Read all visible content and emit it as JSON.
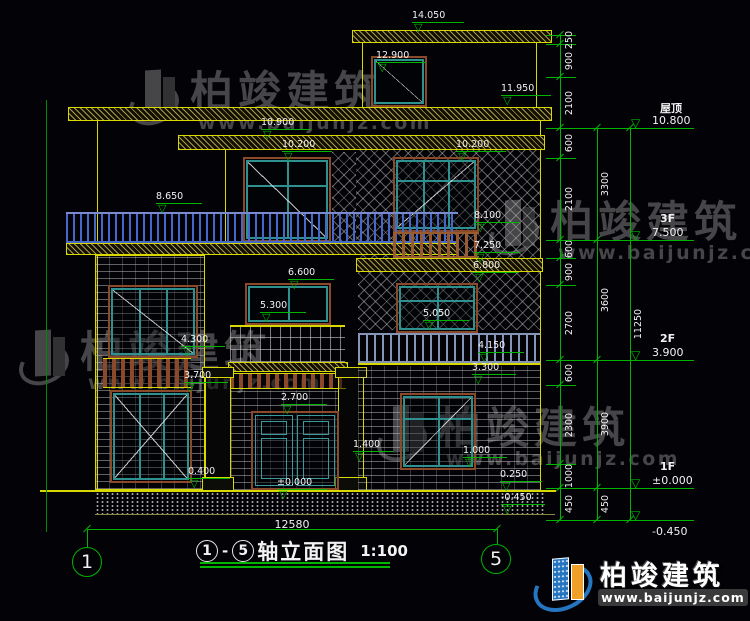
{
  "colors": {
    "line_yellow": "#d9d900",
    "dim_green": "#00b400",
    "text_white": "#f2f2f2",
    "frame_teal": "#2f9090",
    "frame_brown": "#8a4a2a",
    "railing_blue": "#4468cc",
    "logo_blue": "#2575c0",
    "logo_orange": "#f0a028",
    "watermark_gray": "#9a9a9a"
  },
  "icons": {
    "level_triangle": "▽"
  },
  "drawing": {
    "markers": [
      {
        "t": "14.050",
        "x": 412,
        "y": 11,
        "w": 52
      },
      {
        "t": "12.900",
        "x": 376,
        "y": 51,
        "w": 50
      },
      {
        "t": "11.950",
        "x": 501,
        "y": 84,
        "w": 50
      },
      {
        "t": "10.900",
        "x": 261,
        "y": 118,
        "w": 50
      },
      {
        "t": "10.200",
        "x": 282,
        "y": 140,
        "w": 50
      },
      {
        "t": "10.200",
        "x": 456,
        "y": 140,
        "w": 50
      },
      {
        "t": "8.650",
        "x": 156,
        "y": 192,
        "w": 46
      },
      {
        "t": "8.100",
        "x": 474,
        "y": 211,
        "w": 46
      },
      {
        "t": "7.250",
        "x": 474,
        "y": 241,
        "w": 46
      },
      {
        "t": "6.800",
        "x": 473,
        "y": 261,
        "w": 46
      },
      {
        "t": "6.600",
        "x": 288,
        "y": 268,
        "w": 46
      },
      {
        "t": "5.300",
        "x": 260,
        "y": 301,
        "w": 46
      },
      {
        "t": "5.050",
        "x": 423,
        "y": 309,
        "w": 46
      },
      {
        "t": "4.300",
        "x": 181,
        "y": 335,
        "w": 44
      },
      {
        "t": "3.700",
        "x": 184,
        "y": 371,
        "w": 44
      },
      {
        "t": "4.150",
        "x": 478,
        "y": 341,
        "w": 46
      },
      {
        "t": "3.300",
        "x": 472,
        "y": 363,
        "w": 44
      },
      {
        "t": "2.700",
        "x": 281,
        "y": 393,
        "w": 46
      },
      {
        "t": "1.400",
        "x": 353,
        "y": 440,
        "w": 40
      },
      {
        "t": "1.000",
        "x": 463,
        "y": 446,
        "w": 44
      },
      {
        "t": "0.400",
        "x": 188,
        "y": 467,
        "w": 42
      },
      {
        "t": "±0.000",
        "x": 277,
        "y": 478,
        "w": 50
      },
      {
        "t": "0.250",
        "x": 500,
        "y": 470,
        "w": 42
      },
      {
        "t": "-0.450",
        "x": 501,
        "y": 493,
        "w": 44
      }
    ],
    "overall_width": "12580",
    "axes": [
      {
        "n": "1",
        "x": 72,
        "y": 547
      },
      {
        "n": "5",
        "x": 481,
        "y": 544
      }
    ]
  },
  "right_panel": {
    "levels": [
      {
        "floor": "屋顶",
        "value": "10.800",
        "y": 128,
        "below": false
      },
      {
        "floor": "3F",
        "value": "7.500",
        "y": 240,
        "below": false
      },
      {
        "floor": "2F",
        "value": "3.900",
        "y": 360,
        "below": false
      },
      {
        "floor": "1F",
        "value": "±0.000",
        "y": 488,
        "below": false
      },
      {
        "floor": "",
        "value": "-0.450",
        "y": 520,
        "below": true
      }
    ],
    "chain": {
      "x": 560,
      "top": 35,
      "bottom": 520,
      "boundaries": [
        35,
        44,
        77,
        128,
        158,
        240,
        258,
        285,
        360,
        385,
        464,
        488,
        520
      ],
      "segments": [
        "250",
        "900",
        "2100",
        "600",
        "2100",
        "600",
        "900",
        "2700",
        "600",
        "2300",
        "1000",
        "450"
      ],
      "col2": {
        "x": 597,
        "items": [
          {
            "v": "3300",
            "a": 128,
            "b": 240
          },
          {
            "v": "3600",
            "a": 240,
            "b": 360
          },
          {
            "v": "3900",
            "a": 360,
            "b": 488
          },
          {
            "v": "450",
            "a": 488,
            "b": 520
          }
        ]
      },
      "col3": {
        "x": 630,
        "items": [
          {
            "v": "11250",
            "a": 128,
            "b": 520
          }
        ]
      },
      "majors": [
        128,
        240,
        360,
        488,
        520
      ]
    }
  },
  "title_bar": {
    "axis_a": "1",
    "dash": "-",
    "axis_b": "5",
    "name": "轴立面图",
    "scale": "1:100"
  },
  "watermark": {
    "cn": "柏竣建筑",
    "url": "www.baijunjz.com"
  },
  "watermark_positions": [
    {
      "x": 128,
      "y": 62
    },
    {
      "x": 488,
      "y": 192
    },
    {
      "x": 18,
      "y": 322
    },
    {
      "x": 376,
      "y": 398
    }
  ],
  "logo": {
    "cn": "柏竣建筑",
    "url": "www.baijunjz.com"
  }
}
